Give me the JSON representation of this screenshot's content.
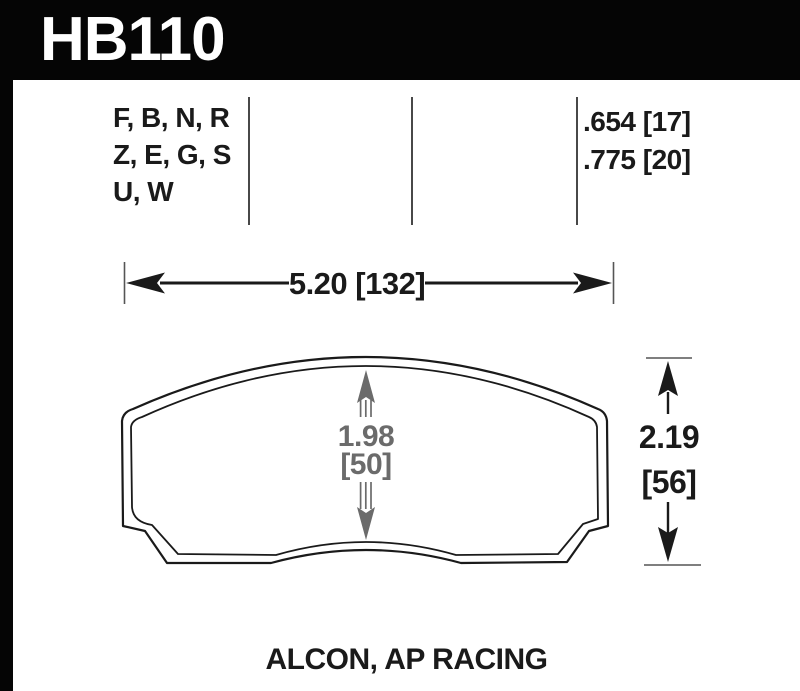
{
  "header": {
    "part_number": "HB110"
  },
  "spec_table": {
    "compounds": [
      "F, B, N, R",
      "Z, E, G, S",
      "U, W"
    ],
    "thickness_values": [
      ".654 [17]",
      ".775 [20]"
    ]
  },
  "dimensions": {
    "width": "5.20 [132]",
    "height_in": "2.19",
    "height_mm": "[56]",
    "center_in": "1.98",
    "center_mm": "[50]"
  },
  "footer": {
    "caliper_applications": "ALCON, AP RACING"
  },
  "colors": {
    "header_bg": "#050505",
    "header_text": "#ffffff",
    "ink": "#1a1a1a",
    "gray_dimension": "#6b6b6b",
    "divider": "#484848"
  }
}
